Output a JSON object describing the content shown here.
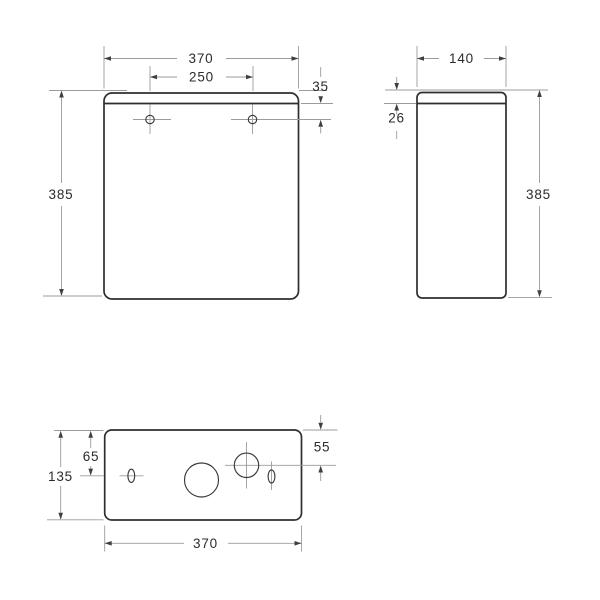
{
  "colors": {
    "background": "#ffffff",
    "outline": "#2e2e2e",
    "hole_outline": "#3a3a3a",
    "dimension_lines": "#9b9b9b",
    "arrowheads": "#3f3f3f",
    "dimension_text": "#2c2c2c"
  },
  "front_view": {
    "overall_width": "370",
    "hole_spacing": "250",
    "lid_to_hole_offset": "35",
    "overall_height": "385"
  },
  "side_view": {
    "overall_depth": "140",
    "lid_height": "26",
    "overall_height": "385"
  },
  "top_view": {
    "slot_centerline_offset": "65",
    "overall_depth": "135",
    "inlet_centerline_offset": "55",
    "overall_width": "370"
  }
}
